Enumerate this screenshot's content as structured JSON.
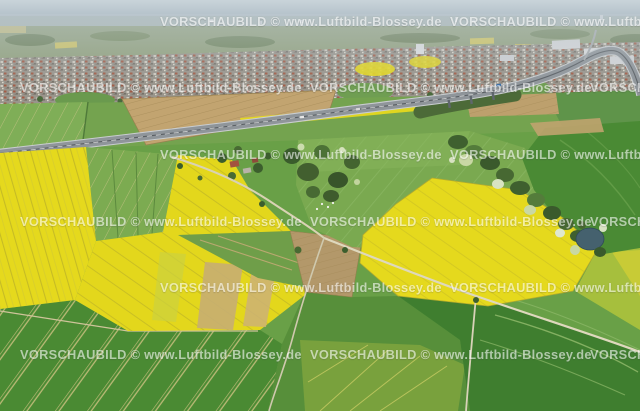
{
  "image": {
    "title": "Aerial photograph: rapeseed and crop fields with motorway, town on horizon",
    "watermark": {
      "text": "VORSCHAUBILD © www.Luftbild-Blossey.de",
      "color": "#ffffff",
      "opacity": 0.58,
      "rows": [
        {
          "y": 22,
          "x_positions": [
            160,
            450
          ]
        },
        {
          "y": 88,
          "x_positions": [
            20,
            310,
            590
          ]
        },
        {
          "y": 155,
          "x_positions": [
            160,
            450
          ]
        },
        {
          "y": 222,
          "x_positions": [
            20,
            310,
            590
          ]
        },
        {
          "y": 288,
          "x_positions": [
            160,
            450
          ]
        },
        {
          "y": 355,
          "x_positions": [
            20,
            310,
            590
          ]
        }
      ]
    },
    "palette": {
      "sky_haze": "#bfcbd3",
      "yellow_field": "#e5d91d",
      "yellow_stripe": "#b4ab2a",
      "green_light": "#7fae52",
      "green_mid": "#5d9640",
      "green_dark": "#417f30",
      "tan_field": "#c2a470",
      "road_asphalt": "#8f959a",
      "road_minor": "#d9d2b4",
      "water": "#45616e",
      "tree": "#3c5e2d",
      "town": "#99958c",
      "wm_color": "#ffffff"
    }
  }
}
